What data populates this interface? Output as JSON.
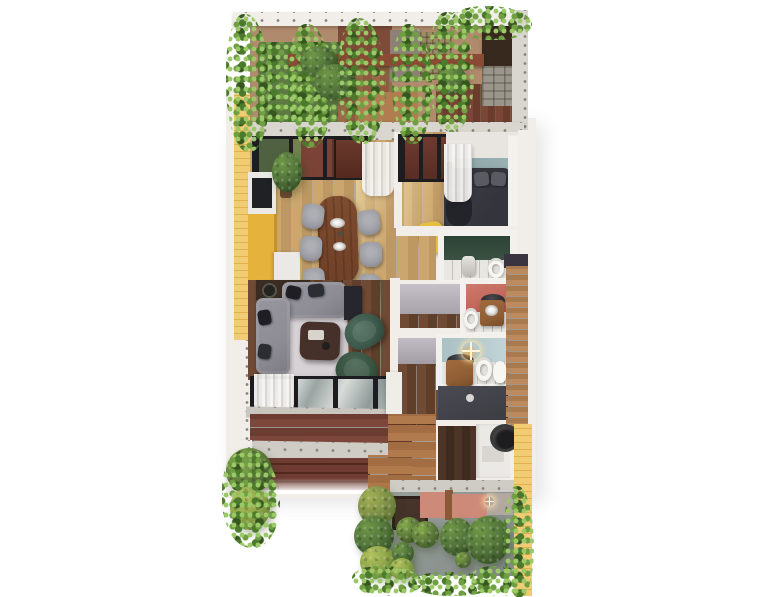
{
  "scene": {
    "kind": "architectural 3D floor-plan render",
    "view": "top-down dollhouse view of an apartment between two planted terraces",
    "visible_text": "none"
  },
  "palette": {
    "background": "#ffffff",
    "wall": "#f1eee9",
    "wall_dark": "#d9d6d0",
    "concrete": "#cfccc6",
    "fastener_dot": "#8a8276",
    "brick_yellow": "#f2cc74",
    "brick_yellow_line": "#e2b14f",
    "cabinet_yellow": "#e5b33c",
    "wood_light_a": "#cba66e",
    "wood_light_b": "#bd9862",
    "wood_dark_a": "#6f4a34",
    "wood_dark_b": "#5f3e2a",
    "deck_red_a": "#7e473c",
    "deck_red_b": "#6d3c31",
    "deck_path_a": "#b07a4c",
    "deck_path_b": "#a26d42",
    "plank_wall_a": "#bb8a5e",
    "plank_wall_b": "#a87a4e",
    "stone_a": "#9a968c",
    "stone_b": "#7e7a70",
    "roof_dark": "#38291f",
    "pergola_beam": "#8a4a33",
    "taupe_wall": "#8d8077",
    "trellis": "#9a8a66",
    "terrace_tan": "#b08a6d",
    "terrace_red_wall": "#7d4b38",
    "garden_patch": "#5d7a44",
    "leaf_light": "#9cc968",
    "leaf_mid": "#6f9f42",
    "leaf_dark": "#4b7a2b",
    "leaf_deep": "#35571f",
    "teal_wall": "#9db4b6",
    "green_wall_a": "#2c4234",
    "green_wall_b": "#3a5243",
    "coral_wall_a": "#b95b4f",
    "coral_wall_b": "#cd7a6c",
    "blue_wall_a": "#a9c0c5",
    "blue_wall_b": "#c2d4d7",
    "hall_wall_a": "#c6c0c8",
    "hall_wall_b": "#a59fa8",
    "rug": "#d7d2d6",
    "sofa": "#8e8c94",
    "pillow_dark": "#1e1e24",
    "pillow_gray": "#2c2c33",
    "chair_gray": "#9d9da5",
    "dining_table_a": "#7e4c30",
    "dining_table_b": "#6f4128",
    "coffee_table": "#453129",
    "armchair_a": "#3e5a4c",
    "armchair_b": "#37523f",
    "bed_base": "#34343b",
    "bed_pillow": "#5a5a63",
    "bed_blanket": "#3e3e46",
    "bed_throw": "#23232a",
    "console_dark": "#3a2c22",
    "tv_unit": "#26262c",
    "curtain_a": "#f6f5f3",
    "curtain_b": "#d9d7d3",
    "tile_floor": "#e9e7e2",
    "porcelain": "#f7f6f3",
    "shower_a": "#3c3c43",
    "shower_b": "#4a4a52",
    "vanity_wood": "#915f35",
    "basin_dark": "#2c2c30",
    "utility_floor_a": "#4c3427",
    "utility_floor_b": "#3e2a1f",
    "appliance_white": "#ebe9e5",
    "tank_black": "#1d1d1f",
    "garden_ground_a": "#9aa19d",
    "garden_ground_b": "#848b88",
    "pink_wall": "#cd8a79",
    "garden_gray_wall": "#b3a89f",
    "window_frame": "#1d1d21",
    "glass_view_green": "#4f6140",
    "glass_view_red": "#7b4337",
    "sill": "#c9c5bf",
    "sparkle": "#fff3d8",
    "ottoman_yellow": "#e5bf3f",
    "bush_dark_l": "#6f9747",
    "bush_dark_m": "#52743a",
    "bush_dark_d": "#324d22",
    "bush_olive_l": "#a3b055",
    "bush_olive_m": "#7c8f47",
    "bush_olive_d": "#55682c",
    "bush_lime_l": "#b2c25d",
    "bush_lime_m": "#8ca448",
    "bush_lime_d": "#5f7a2e",
    "bush_green_l": "#85aa4c",
    "bush_green_m": "#5d7a3a",
    "bush_green_d": "#3a5526"
  },
  "rooms": [
    {
      "id": "roof-terrace",
      "label": "pergola terrace",
      "features": [
        "climbing vines on pergola",
        "timber deck",
        "stone feature wall",
        "dark canopy box",
        "planted bed"
      ]
    },
    {
      "id": "kitchen-dining",
      "label": "kitchen and dining room",
      "features": [
        "yellow cabinets",
        "white counters with dark cooktop",
        "wooden dining table",
        "seven gray chairs",
        "potted plant",
        "glass wall to terrace",
        "sheer curtain"
      ]
    },
    {
      "id": "bedroom",
      "label": "bedroom",
      "features": [
        "dark double bed",
        "teal accent wall",
        "sheer curtain",
        "yellow ottoman",
        "white wardrobe"
      ]
    },
    {
      "id": "ensuite-bathroom",
      "label": "en-suite bathroom",
      "features": [
        "dark green accent wall",
        "white tile floor",
        "toilet",
        "shower fixture"
      ]
    },
    {
      "id": "living-room",
      "label": "living room",
      "features": [
        "gray corner sofa",
        "dark pillows",
        "console with lamps",
        "media unit",
        "coffee table",
        "two green armchairs",
        "pale rug",
        "window wall with sheer curtain"
      ]
    },
    {
      "id": "hallway",
      "label": "hallway",
      "features": [
        "dark wood floor",
        "gray walls",
        "white storage cabinet"
      ]
    },
    {
      "id": "powder-room",
      "label": "powder room",
      "features": [
        "coral accent wall",
        "toilet",
        "wooden vanity with dark basin"
      ]
    },
    {
      "id": "family-bathroom",
      "label": "family bathroom",
      "features": [
        "light blue accent wall",
        "wooden vanity with dark basin",
        "toilet",
        "bidet",
        "dark shower",
        "light sparkle highlight"
      ]
    },
    {
      "id": "utility-room",
      "label": "utility room",
      "features": [
        "dark wood floor",
        "white appliances",
        "round black tank"
      ]
    },
    {
      "id": "rear-terrace",
      "label": "rear terrace",
      "features": [
        "red-brown deck",
        "concrete parapet with fixings",
        "steps",
        "corner shrub"
      ]
    },
    {
      "id": "garden",
      "label": "rear garden",
      "features": [
        "round clipped shrubs in several greens",
        "ivy ground cover",
        "pink wall",
        "dark window",
        "vine on yellow brick wall"
      ]
    }
  ]
}
